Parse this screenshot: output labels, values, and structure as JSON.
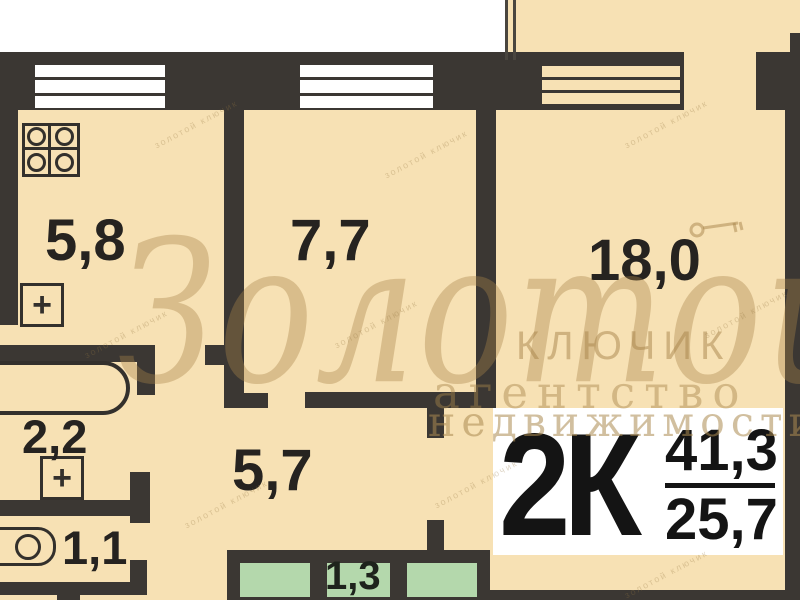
{
  "plan_type": "apartment-floor-plan",
  "rooms": {
    "kitchen_area": "5,8",
    "room1_area": "7,7",
    "room2_area": "18,0",
    "bathroom_area": "2,2",
    "hall_area": "5,7",
    "wc_area": "1,1",
    "closet_area": "1,3"
  },
  "badge": {
    "rooms_count": "2К",
    "total_area": "41,3",
    "living_area": "25,7"
  },
  "watermark": {
    "script": "Золотой",
    "line2": "КЛЮЧИК",
    "line3": "агентство",
    "line4": "недвижимости",
    "pattern": "золотой ключик"
  },
  "fixtures": {
    "vent_symbol": "+"
  },
  "colors": {
    "background": "#f7e1b4",
    "wall": "#3b3733",
    "exterior": "#ffffff",
    "closet_green": "#b4d8ac",
    "badge_background": "#ffffff",
    "badge_text": "#141414",
    "label_text": "#262320",
    "watermark": "#a7844a"
  }
}
